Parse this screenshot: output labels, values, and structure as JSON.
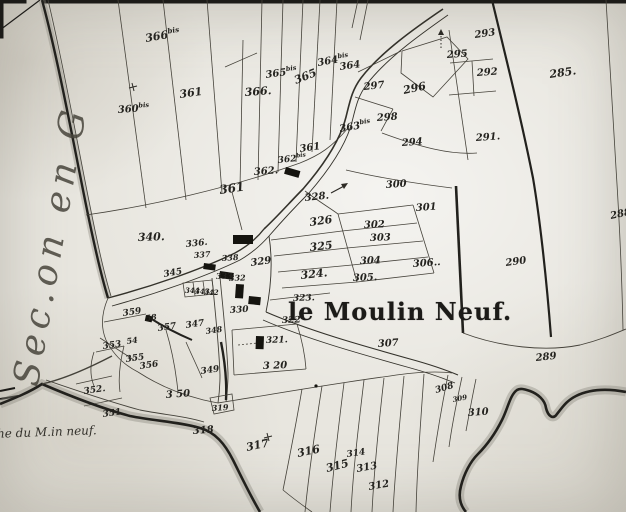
{
  "map": {
    "title": "le Moulin Neuf.",
    "margin_label": "Sec.on en G",
    "road_label": "he du M.in neuf.",
    "ink_color": "#3a3832",
    "paper_color": "#e8e6df",
    "parcel_labels": [
      {
        "t": "366",
        "sup": "bis",
        "x": 146,
        "y": 42,
        "s": 11,
        "r": -10
      },
      {
        "t": "361",
        "x": 180,
        "y": 98,
        "s": 11,
        "r": -8
      },
      {
        "t": "366.",
        "x": 245,
        "y": 96,
        "s": 11,
        "r": -4
      },
      {
        "t": "365",
        "sup": "bis",
        "x": 266,
        "y": 78,
        "s": 10,
        "r": -8
      },
      {
        "t": "365",
        "x": 296,
        "y": 84,
        "s": 11,
        "r": -22
      },
      {
        "t": "364",
        "sup": "bis",
        "x": 318,
        "y": 66,
        "s": 10,
        "r": -10
      },
      {
        "t": "364",
        "x": 340,
        "y": 70,
        "s": 10,
        "r": -8
      },
      {
        "t": "363",
        "sup": "bis",
        "x": 340,
        "y": 132,
        "s": 10,
        "r": -10
      },
      {
        "t": "293",
        "x": 475,
        "y": 38,
        "s": 10,
        "r": -8
      },
      {
        "t": "295",
        "x": 447,
        "y": 58,
        "s": 10,
        "r": -4
      },
      {
        "t": "292",
        "x": 477,
        "y": 76,
        "s": 10,
        "r": -4
      },
      {
        "t": "285.",
        "x": 550,
        "y": 78,
        "s": 11,
        "r": -8
      },
      {
        "t": "297",
        "x": 364,
        "y": 90,
        "s": 10,
        "r": -6
      },
      {
        "t": "296",
        "x": 404,
        "y": 94,
        "s": 11,
        "r": -12
      },
      {
        "t": "298",
        "x": 377,
        "y": 121,
        "s": 10,
        "r": -4
      },
      {
        "t": "294",
        "x": 402,
        "y": 146,
        "s": 10,
        "r": -4
      },
      {
        "t": "291.",
        "x": 476,
        "y": 141,
        "s": 10,
        "r": -4
      },
      {
        "t": "288",
        "x": 611,
        "y": 219,
        "s": 10,
        "r": -12
      },
      {
        "t": "290",
        "x": 506,
        "y": 266,
        "s": 10,
        "r": -8
      },
      {
        "t": "289",
        "x": 536,
        "y": 361,
        "s": 10,
        "r": -6
      },
      {
        "t": "360",
        "sup": "bis",
        "x": 118,
        "y": 113,
        "s": 10,
        "r": -4
      },
      {
        "t": "362.",
        "x": 254,
        "y": 175,
        "s": 10,
        "r": -4
      },
      {
        "t": "362",
        "sup": "bis",
        "x": 278,
        "y": 163,
        "s": 9,
        "r": -6
      },
      {
        "t": "361",
        "x": 220,
        "y": 194,
        "s": 12,
        "r": -8
      },
      {
        "t": "361",
        "x": 300,
        "y": 152,
        "s": 10,
        "r": -8
      },
      {
        "t": "340.",
        "x": 138,
        "y": 241,
        "s": 11,
        "r": -2
      },
      {
        "t": "328.",
        "x": 305,
        "y": 201,
        "s": 10,
        "r": -6
      },
      {
        "t": "300",
        "x": 386,
        "y": 188,
        "s": 10,
        "r": -4
      },
      {
        "t": "301",
        "x": 416,
        "y": 211,
        "s": 10,
        "r": -4
      },
      {
        "t": "326",
        "x": 310,
        "y": 226,
        "s": 11,
        "r": -8
      },
      {
        "t": "302",
        "x": 364,
        "y": 228,
        "s": 10,
        "r": -2
      },
      {
        "t": "303",
        "x": 370,
        "y": 241,
        "s": 10,
        "r": -2
      },
      {
        "t": "325",
        "x": 310,
        "y": 251,
        "s": 11,
        "r": -6
      },
      {
        "t": "304",
        "x": 360,
        "y": 264,
        "s": 10,
        "r": -2
      },
      {
        "t": "306..",
        "x": 413,
        "y": 267,
        "s": 10,
        "r": -4
      },
      {
        "t": "324.",
        "x": 301,
        "y": 279,
        "s": 11,
        "r": -6
      },
      {
        "t": "305.",
        "x": 353,
        "y": 281,
        "s": 10,
        "r": -2
      },
      {
        "t": "336.",
        "x": 186,
        "y": 247,
        "s": 9,
        "r": -6
      },
      {
        "t": "337",
        "x": 194,
        "y": 258,
        "s": 8,
        "r": -4
      },
      {
        "t": "338",
        "x": 222,
        "y": 261,
        "s": 8,
        "r": -4
      },
      {
        "t": "329",
        "x": 251,
        "y": 266,
        "s": 10,
        "r": -8
      },
      {
        "t": "345",
        "x": 164,
        "y": 277,
        "s": 9,
        "r": -10
      },
      {
        "t": "333",
        "x": 216,
        "y": 279,
        "s": 8,
        "r": -2
      },
      {
        "t": "332",
        "x": 229,
        "y": 281,
        "s": 8,
        "r": -2
      },
      {
        "t": "344",
        "x": 185,
        "y": 293,
        "s": 7,
        "r": 0
      },
      {
        "t": "343",
        "x": 195,
        "y": 294,
        "s": 7,
        "r": 0
      },
      {
        "t": "342",
        "x": 204,
        "y": 295,
        "s": 7,
        "r": 0
      },
      {
        "t": "330",
        "x": 230,
        "y": 313,
        "s": 9,
        "r": -4
      },
      {
        "t": "323.",
        "x": 293,
        "y": 301,
        "s": 9,
        "r": -2
      },
      {
        "t": "322",
        "x": 282,
        "y": 323,
        "s": 9,
        "r": -2
      },
      {
        "t": "321.",
        "x": 266,
        "y": 343,
        "s": 9,
        "r": -2
      },
      {
        "t": "3 20",
        "x": 263,
        "y": 369,
        "s": 10,
        "r": -2
      },
      {
        "t": "359",
        "x": 123,
        "y": 316,
        "s": 9,
        "r": -8
      },
      {
        "t": "58",
        "x": 146,
        "y": 321,
        "s": 8,
        "r": -8
      },
      {
        "t": "357",
        "x": 158,
        "y": 331,
        "s": 9,
        "r": -8
      },
      {
        "t": "347",
        "x": 186,
        "y": 328,
        "s": 9,
        "r": -8
      },
      {
        "t": "348",
        "x": 206,
        "y": 334,
        "s": 8,
        "r": -8
      },
      {
        "t": "353",
        "x": 103,
        "y": 349,
        "s": 9,
        "r": -8
      },
      {
        "t": "54",
        "x": 127,
        "y": 344,
        "s": 8,
        "r": -8
      },
      {
        "t": "355",
        "x": 126,
        "y": 362,
        "s": 9,
        "r": -8
      },
      {
        "t": "356",
        "x": 140,
        "y": 369,
        "s": 9,
        "r": -8
      },
      {
        "t": "352.",
        "x": 84,
        "y": 394,
        "s": 9,
        "r": -8
      },
      {
        "t": "351",
        "x": 103,
        "y": 417,
        "s": 9,
        "r": -8
      },
      {
        "t": "3 50",
        "x": 166,
        "y": 398,
        "s": 10,
        "r": -4
      },
      {
        "t": "349",
        "x": 201,
        "y": 374,
        "s": 9,
        "r": -8
      },
      {
        "t": "319",
        "x": 212,
        "y": 411,
        "s": 8,
        "r": -4
      },
      {
        "t": "318",
        "x": 193,
        "y": 434,
        "s": 10,
        "r": -4
      },
      {
        "t": "317",
        "x": 247,
        "y": 451,
        "s": 11,
        "r": -12
      },
      {
        "t": "316",
        "x": 298,
        "y": 457,
        "s": 11,
        "r": -12
      },
      {
        "t": "315",
        "x": 327,
        "y": 472,
        "s": 11,
        "r": -14
      },
      {
        "t": "314",
        "x": 347,
        "y": 457,
        "s": 9,
        "r": -8
      },
      {
        "t": "313",
        "x": 357,
        "y": 472,
        "s": 10,
        "r": -10
      },
      {
        "t": "312",
        "x": 369,
        "y": 490,
        "s": 10,
        "r": -10
      },
      {
        "t": "308",
        "x": 436,
        "y": 393,
        "s": 9,
        "r": -16
      },
      {
        "t": "309",
        "x": 453,
        "y": 402,
        "s": 7,
        "r": -10
      },
      {
        "t": "310",
        "x": 468,
        "y": 416,
        "s": 10,
        "r": -4
      },
      {
        "t": "307",
        "x": 378,
        "y": 347,
        "s": 10,
        "r": -4
      }
    ]
  }
}
